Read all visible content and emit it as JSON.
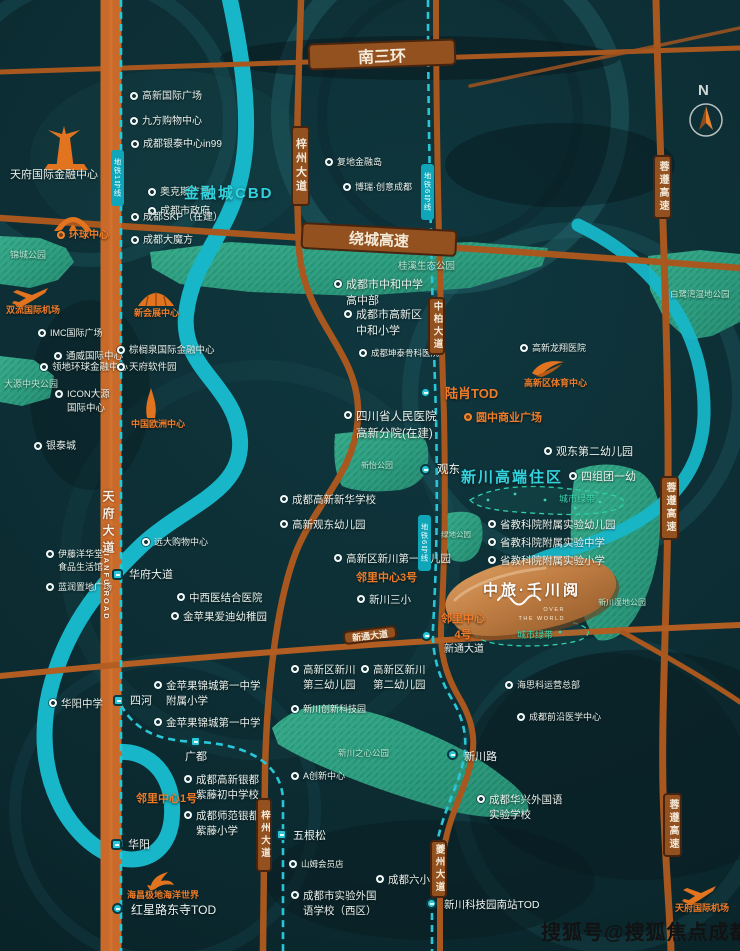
{
  "compass": {
    "n": "N"
  },
  "watermark": "搜狐号@搜狐焦点成都站",
  "project": {
    "name": "中旅·千川阅",
    "sub1": "OVER",
    "sub2": "THE WORLD"
  },
  "area_labels": [
    {
      "t": "金融城CBD",
      "x": 184,
      "y": 182,
      "f": 15
    },
    {
      "t": "新川高端住区",
      "x": 461,
      "y": 466,
      "f": 15
    }
  ],
  "park_labels": [
    {
      "t": "锦城公园",
      "x": 10,
      "y": 248,
      "f": 9
    },
    {
      "t": "桂溪生态公园",
      "x": 398,
      "y": 258,
      "f": 9.5
    },
    {
      "t": "大源中央公园",
      "x": 4,
      "y": 377,
      "f": 9
    },
    {
      "t": "白鹭湾湿地公园",
      "x": 670,
      "y": 288,
      "f": 8.5
    },
    {
      "t": "新怡公园",
      "x": 361,
      "y": 460,
      "f": 8
    },
    {
      "t": "绿地公园",
      "x": 441,
      "y": 529,
      "f": 7.5
    },
    {
      "t": "新川湿地公园",
      "x": 598,
      "y": 597,
      "f": 8
    },
    {
      "t": "新川之心公园",
      "x": 338,
      "y": 747,
      "f": 8.5
    },
    {
      "t": "城市绿带",
      "x": 559,
      "y": 492,
      "f": 9,
      "c": "belt-label"
    },
    {
      "t": "城市绿带",
      "x": 517,
      "y": 628,
      "f": 9,
      "c": "belt-label"
    }
  ],
  "hpills": [
    {
      "t": "南三环",
      "x": 308,
      "y": 41,
      "w": 148,
      "h": 27,
      "f": 16,
      "r": -2
    },
    {
      "t": "绕城高速",
      "x": 301,
      "y": 226,
      "w": 156,
      "h": 27,
      "f": 15,
      "r": 3
    },
    {
      "t": "新通大道",
      "x": 343,
      "y": 628,
      "w": 54,
      "h": 14,
      "f": 9,
      "r": -7
    }
  ],
  "vpills": [
    {
      "t": "梓州大道",
      "x": 291,
      "y": 126,
      "w": 19,
      "h": 80,
      "f": 11
    },
    {
      "t": "中柏大道",
      "x": 428,
      "y": 297,
      "w": 17,
      "h": 58,
      "f": 9.5
    },
    {
      "t": "蓉遵高速",
      "x": 653,
      "y": 155,
      "w": 19,
      "h": 64,
      "f": 10
    },
    {
      "t": "蓉遵高速",
      "x": 660,
      "y": 476,
      "w": 19,
      "h": 64,
      "f": 10
    },
    {
      "t": "蓉遵高速",
      "x": 663,
      "y": 793,
      "w": 19,
      "h": 64,
      "f": 10
    },
    {
      "t": "夔州大道",
      "x": 430,
      "y": 840,
      "w": 17,
      "h": 58,
      "f": 9.5
    },
    {
      "t": "梓州大道",
      "x": 256,
      "y": 798,
      "w": 16,
      "h": 74,
      "f": 9.5
    }
  ],
  "mpills": [
    {
      "t": "地铁1号线",
      "x": 111,
      "y": 150,
      "w": 13,
      "h": 56
    },
    {
      "t": "地铁6号线",
      "x": 421,
      "y": 164,
      "w": 13,
      "h": 56
    },
    {
      "t": "地铁6号线",
      "x": 418,
      "y": 515,
      "w": 13,
      "h": 56
    }
  ],
  "road_texts": [
    {
      "t": "天府大道",
      "x": 100,
      "y": 490,
      "f": 12,
      "ls": 5
    },
    {
      "t": "TIANFU ROAD",
      "x": 102,
      "y": 547,
      "f": 7.5,
      "ls": 2
    }
  ],
  "stations": [
    {
      "t": "华府大道",
      "mx": 112,
      "my": 569,
      "lx": 129,
      "ly": 566,
      "sh": "sq",
      "f": 11
    },
    {
      "t": "四河",
      "mx": 113,
      "my": 695,
      "lx": 130,
      "ly": 692,
      "sh": "sq",
      "f": 11
    },
    {
      "t": "广都",
      "mx": 190,
      "my": 736,
      "lx": 185,
      "ly": 748,
      "sh": "sq",
      "f": 11
    },
    {
      "t": "华阳",
      "mx": 111,
      "my": 839,
      "lx": 128,
      "ly": 836,
      "sh": "sq",
      "f": 11
    },
    {
      "t": "红星路东寺TOD",
      "mx": 112,
      "my": 903,
      "lx": 131,
      "ly": 901,
      "sh": "rd",
      "f": 12
    },
    {
      "t": "五根松",
      "mx": 276,
      "my": 829,
      "lx": 293,
      "ly": 827,
      "sh": "sq",
      "f": 11
    },
    {
      "t": "观东",
      "mx": 420,
      "my": 464,
      "lx": 437,
      "ly": 461,
      "sh": "rd",
      "f": 11.5
    },
    {
      "t": "新通大道",
      "mx": 421,
      "my": 630,
      "lx": 444,
      "ly": 640,
      "sh": "rd",
      "f": 10
    },
    {
      "t": "新川路",
      "mx": 447,
      "my": 749,
      "lx": 464,
      "ly": 748,
      "sh": "rd",
      "f": 11
    },
    {
      "t": "新川科技园南站TOD",
      "mx": 426,
      "my": 898,
      "lx": 444,
      "ly": 897,
      "sh": "rd",
      "f": 10.5
    },
    {
      "t": "",
      "mx": 420,
      "my": 387,
      "sh": "rd"
    }
  ],
  "pois": [
    {
      "t": [
        "高新国际广场"
      ],
      "x": 130,
      "y": 90
    },
    {
      "t": [
        "九方购物中心"
      ],
      "x": 130,
      "y": 115
    },
    {
      "t": [
        "天府国际金融中心"
      ],
      "x": 10,
      "y": 168,
      "nb": true,
      "f": 11
    },
    {
      "t": [
        "奥克斯广场"
      ],
      "x": 148,
      "y": 186
    },
    {
      "t": [
        "成都市政府"
      ],
      "x": 148,
      "y": 205
    },
    {
      "t": [
        "成都银泰中心in99"
      ],
      "x": 131,
      "y": 138
    },
    {
      "t": [
        "成都SKP（在建）"
      ],
      "x": 131,
      "y": 211
    },
    {
      "t": [
        "成都大魔方"
      ],
      "x": 131,
      "y": 234
    },
    {
      "t": [
        "复地金融岛"
      ],
      "x": 325,
      "y": 156,
      "f": 9
    },
    {
      "t": [
        "博瑞·创意成都"
      ],
      "x": 343,
      "y": 181,
      "f": 9
    },
    {
      "t": [
        "IMC国际广场"
      ],
      "x": 38,
      "y": 327,
      "f": 9
    },
    {
      "t": [
        "通威国际中心"
      ],
      "x": 54,
      "y": 350,
      "f": 9.5
    },
    {
      "t": [
        "领地环球金融中心"
      ],
      "x": 40,
      "y": 361,
      "f": 9.5
    },
    {
      "t": [
        "ICON大源",
        "国际中心"
      ],
      "x": 55,
      "y": 388,
      "f": 9.5
    },
    {
      "t": [
        "银泰城"
      ],
      "x": 34,
      "y": 440
    },
    {
      "t": [
        "棕榈泉国际金融中心"
      ],
      "x": 117,
      "y": 344,
      "f": 9.5
    },
    {
      "t": [
        "天府软件园"
      ],
      "x": 117,
      "y": 361,
      "f": 9.5
    },
    {
      "t": [
        "成都市中和中学",
        "高中部"
      ],
      "x": 334,
      "y": 278,
      "f": 11
    },
    {
      "t": [
        "成都市高新区",
        "中和小学"
      ],
      "x": 344,
      "y": 308,
      "f": 11
    },
    {
      "t": [
        "成都坤泰骨科医院"
      ],
      "x": 359,
      "y": 347,
      "f": 8.5
    },
    {
      "t": [
        "四川省人民医院",
        "高新分院(在建)"
      ],
      "x": 344,
      "y": 409,
      "f": 11.5
    },
    {
      "t": [
        "成都高新新华学校"
      ],
      "x": 280,
      "y": 493,
      "f": 10.5
    },
    {
      "t": [
        "高新观东幼儿园"
      ],
      "x": 280,
      "y": 518,
      "f": 10.5
    },
    {
      "t": [
        "中西医结合医院"
      ],
      "x": 177,
      "y": 591,
      "f": 10.5
    },
    {
      "t": [
        "金苹果爱迪幼稚园"
      ],
      "x": 171,
      "y": 610,
      "f": 10.5
    },
    {
      "t": [
        "高新区新川第一幼儿园"
      ],
      "x": 334,
      "y": 552,
      "f": 10.5
    },
    {
      "t": [
        "新川三小"
      ],
      "x": 357,
      "y": 593,
      "f": 10.5
    },
    {
      "t": [
        "远大购物中心"
      ],
      "x": 142,
      "y": 536,
      "f": 9
    },
    {
      "t": [
        "伊藤洋华堂",
        "食品生活馆"
      ],
      "x": 46,
      "y": 548,
      "f": 9
    },
    {
      "t": [
        "蓝润置地广场"
      ],
      "x": 46,
      "y": 581,
      "f": 9
    },
    {
      "t": [
        "华阳中学"
      ],
      "x": 49,
      "y": 697,
      "f": 10.5
    },
    {
      "t": [
        "金苹果锦城第一中学",
        "附属小学"
      ],
      "x": 154,
      "y": 679,
      "f": 10.5
    },
    {
      "t": [
        "金苹果锦城第一中学"
      ],
      "x": 154,
      "y": 716,
      "f": 10.5
    },
    {
      "t": [
        "成都高新银都",
        "紫藤初中学校"
      ],
      "x": 184,
      "y": 773,
      "f": 10.5
    },
    {
      "t": [
        "成都师范银都",
        "紫藤小学"
      ],
      "x": 184,
      "y": 809,
      "f": 10.5
    },
    {
      "t": [
        "山姆会员店"
      ],
      "x": 289,
      "y": 858,
      "f": 8.5
    },
    {
      "t": [
        "成都六小"
      ],
      "x": 376,
      "y": 873,
      "f": 10.5
    },
    {
      "t": [
        "成都市实验外国",
        "语学校（西区）"
      ],
      "x": 291,
      "y": 889,
      "f": 10.5
    },
    {
      "t": [
        "成都前沿医学中心"
      ],
      "x": 517,
      "y": 711,
      "f": 9
    },
    {
      "t": [
        "海思科运营总部"
      ],
      "x": 505,
      "y": 679,
      "f": 9
    },
    {
      "t": [
        "成都华兴外国语",
        "实验学校"
      ],
      "x": 477,
      "y": 793,
      "f": 10.5
    },
    {
      "t": [
        "观东第二幼儿园"
      ],
      "x": 544,
      "y": 445,
      "f": 11
    },
    {
      "t": [
        "四组团一幼"
      ],
      "x": 569,
      "y": 470,
      "f": 11
    },
    {
      "t": [
        "高新龙翔医院"
      ],
      "x": 520,
      "y": 342,
      "f": 9
    },
    {
      "t": [
        "省教科院附属实验幼儿园"
      ],
      "x": 488,
      "y": 518,
      "f": 10.5
    },
    {
      "t": [
        "省教科院附属实验中学"
      ],
      "x": 488,
      "y": 536,
      "f": 10.5
    },
    {
      "t": [
        "省教科院附属实验小学"
      ],
      "x": 488,
      "y": 554,
      "f": 10.5
    },
    {
      "t": [
        "高新区新川",
        "第三幼儿园"
      ],
      "x": 291,
      "y": 663,
      "f": 10.5
    },
    {
      "t": [
        "高新区新川",
        "第二幼儿园"
      ],
      "x": 361,
      "y": 663,
      "f": 10.5
    },
    {
      "t": [
        "新川创新科技园"
      ],
      "x": 291,
      "y": 703,
      "f": 9
    },
    {
      "t": [
        "A创新中心"
      ],
      "x": 291,
      "y": 770,
      "f": 9
    },
    {
      "t": [
        "环球中心"
      ],
      "x": 57,
      "y": 229,
      "c": "orange",
      "ob": true,
      "f": 10
    },
    {
      "t": [
        "双流国际机场"
      ],
      "x": 6,
      "y": 304,
      "c": "orange",
      "nb": true,
      "f": 9
    },
    {
      "t": [
        "新会展中心"
      ],
      "x": 134,
      "y": 307,
      "c": "orange",
      "nb": true,
      "f": 9
    },
    {
      "t": [
        "中国欧洲中心"
      ],
      "x": 131,
      "y": 418,
      "c": "orange",
      "nb": true,
      "f": 9
    },
    {
      "t": [
        "高新区体育中心"
      ],
      "x": 524,
      "y": 377,
      "c": "orange",
      "nb": true,
      "f": 9
    },
    {
      "t": [
        "陆肖TOD"
      ],
      "x": 445,
      "y": 385,
      "c": "orange",
      "nb": true,
      "f": 13
    },
    {
      "t": [
        "圆中商业广场"
      ],
      "x": 464,
      "y": 411,
      "c": "orange",
      "ob": true,
      "f": 11
    },
    {
      "t": [
        "邻里中心3号"
      ],
      "x": 356,
      "y": 571,
      "c": "orange",
      "nb": true,
      "f": 11
    },
    {
      "t": [
        "邻里中心",
        "4号"
      ],
      "x": 441,
      "y": 612,
      "c": "orange center",
      "nb": true,
      "f": 11
    },
    {
      "t": [
        "邻里中心1号"
      ],
      "x": 136,
      "y": 792,
      "c": "orange",
      "nb": true,
      "f": 11
    },
    {
      "t": [
        "海昌极地海洋世界"
      ],
      "x": 127,
      "y": 889,
      "c": "orange",
      "nb": true,
      "f": 9
    },
    {
      "t": [
        "天府国际机场"
      ],
      "x": 675,
      "y": 902,
      "c": "orange",
      "nb": true,
      "f": 9
    }
  ]
}
